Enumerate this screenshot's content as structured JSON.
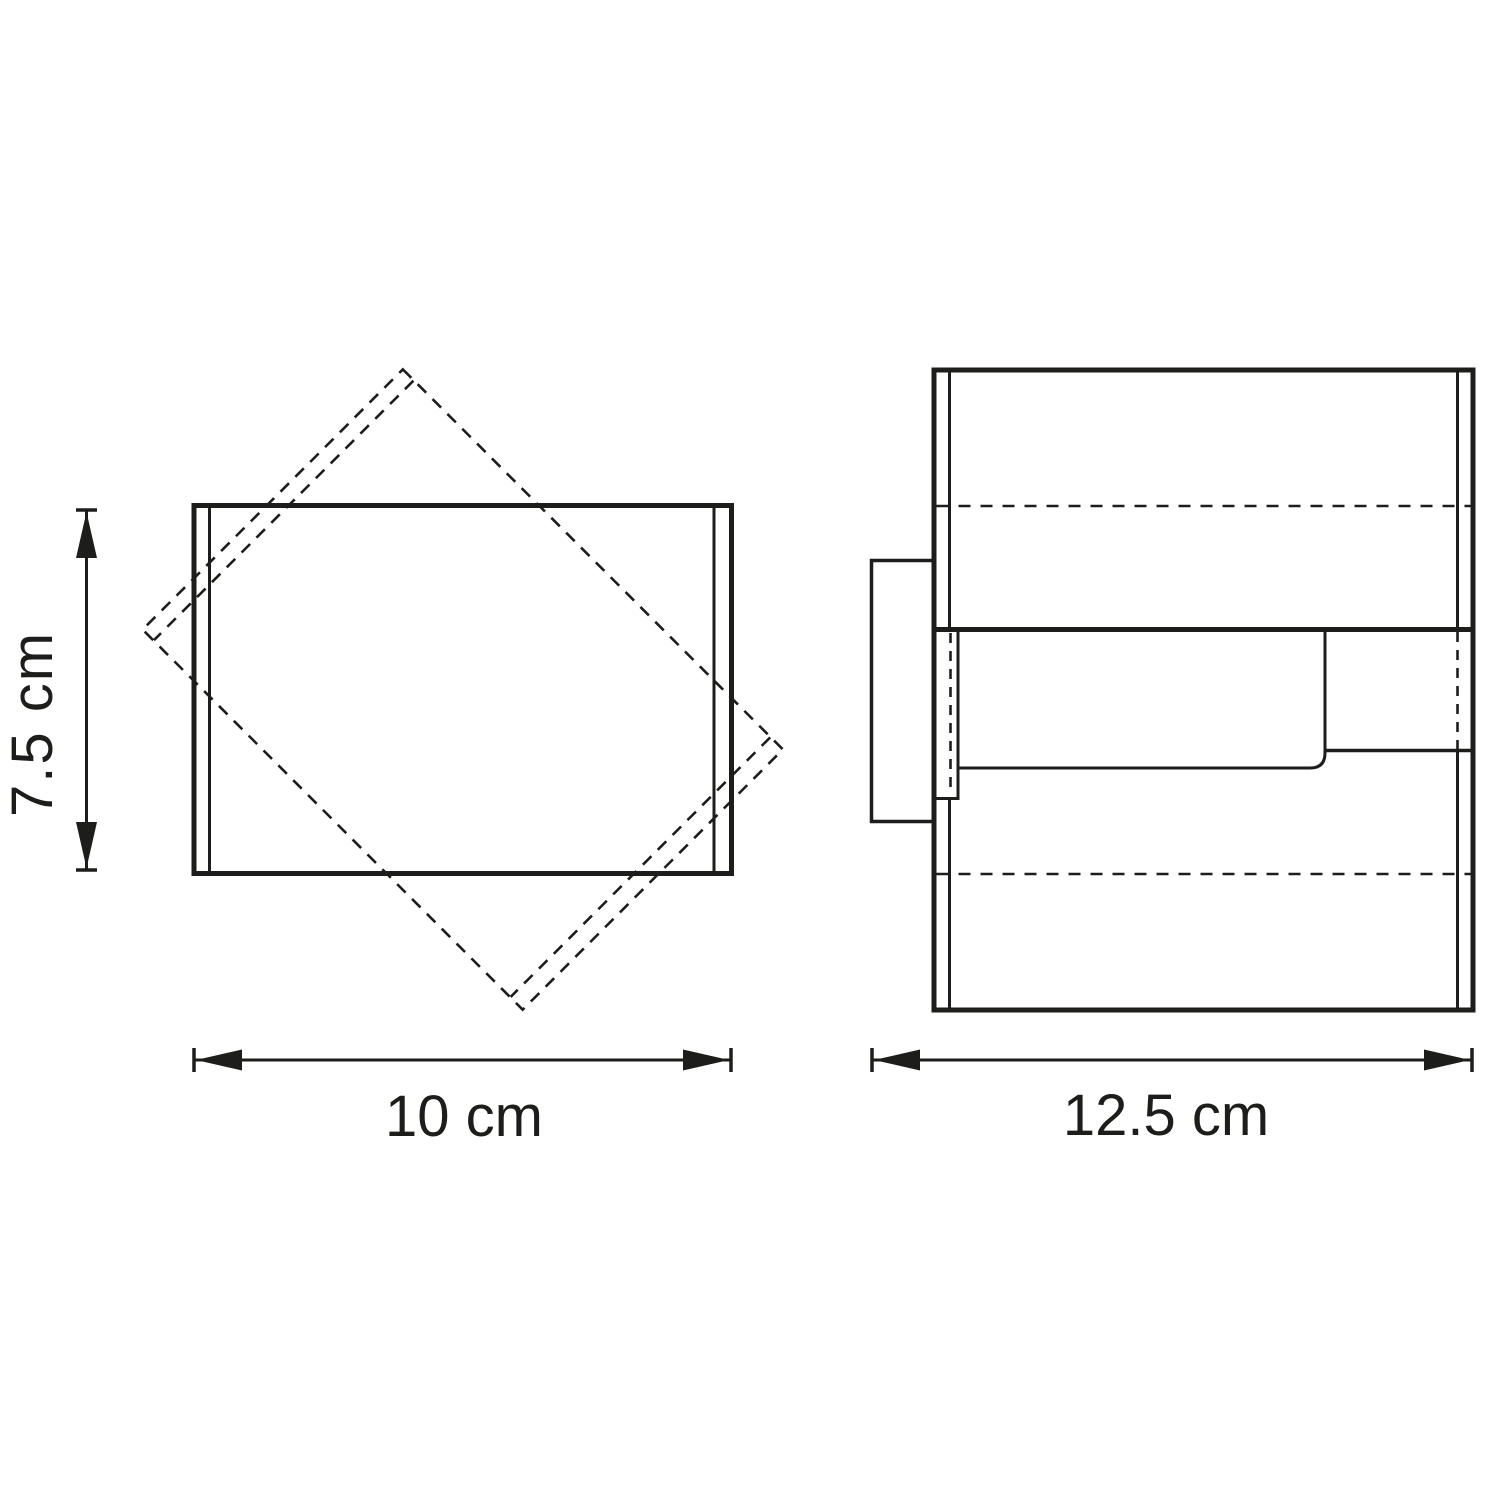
{
  "drawing": {
    "description": "Technical dimension drawing, two views of a cube wall lamp",
    "labels": {
      "height": "7.5 cm",
      "width": "10 cm",
      "depth": "12.5 cm"
    }
  },
  "colors": {
    "line": "#1d1d1b",
    "background": "#ffffff"
  }
}
